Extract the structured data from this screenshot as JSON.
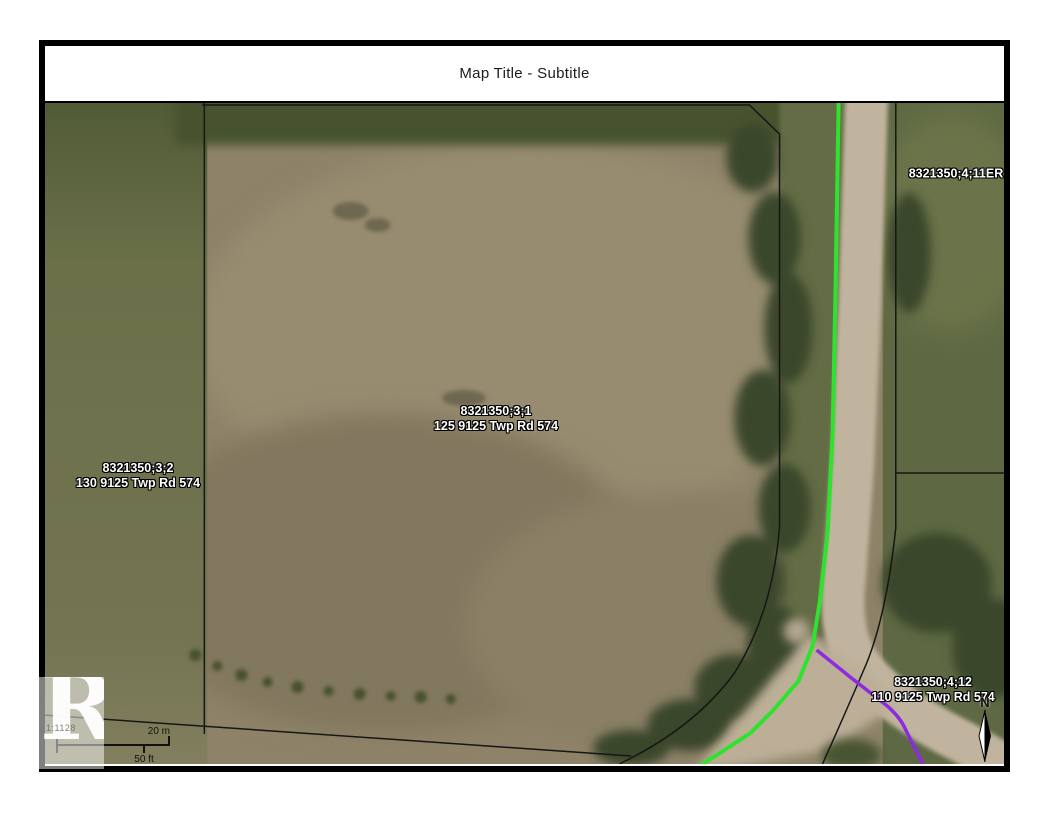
{
  "title": "Map Title - Subtitle",
  "map": {
    "parcels": [
      {
        "id": "8321350;3;1",
        "address": "125 9125 Twp Rd 574"
      },
      {
        "id": "8321350;3;2",
        "address": "130 9125 Twp Rd 574"
      },
      {
        "id": "8321350;4;11ER"
      },
      {
        "id": "8321350;4;12",
        "address": "110 9125 Twp Rd 574"
      }
    ],
    "scale_bar": {
      "metric_label": "20 m",
      "imperial_label": "50 ft"
    },
    "scale_ratio": "1:1128",
    "north_label": "N",
    "logo_letter": "R",
    "colors": {
      "parcel_line": "#161616",
      "selection_green": "#2ee32e",
      "selection_purple": "#8b2be2",
      "road": "#c1b49e",
      "field_brown": "#8e8369",
      "grass_green": "#6f744f"
    }
  }
}
